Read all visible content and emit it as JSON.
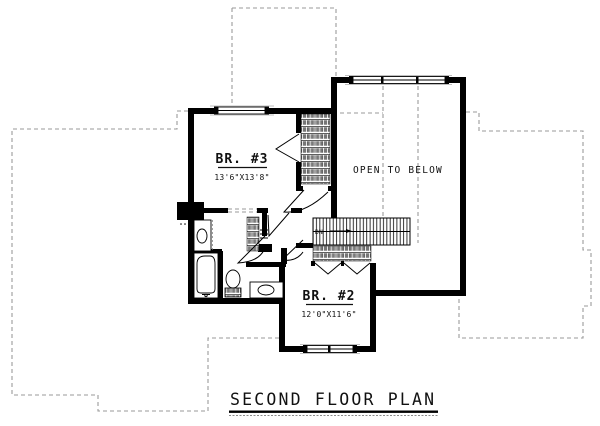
{
  "title": {
    "text": "SECOND FLOOR PLAN"
  },
  "rooms": {
    "br3": {
      "label": "BR. #3",
      "dims": "13'6\"X13'8\""
    },
    "open_below": {
      "label": "OPEN TO BELOW"
    },
    "br2": {
      "label": "BR. #2",
      "dims": "12'0\"X11'6\""
    }
  },
  "stairs": {
    "label": "DN"
  },
  "colors": {
    "wall": "#000000",
    "footprint_dash": "#9a9a9a",
    "background": "#ffffff"
  }
}
